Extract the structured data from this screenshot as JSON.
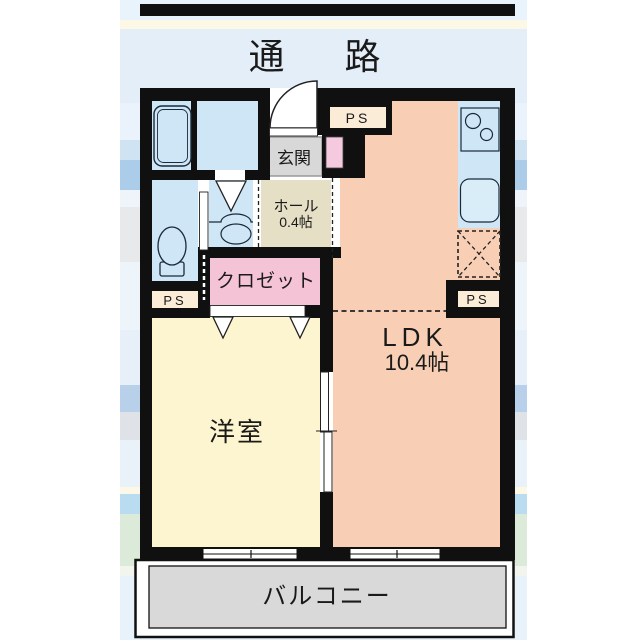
{
  "corridor": {
    "label": "通 路"
  },
  "plan": {
    "entrance": {
      "label": "玄関"
    },
    "hall": {
      "label": "ホール",
      "size": "0.4帖"
    },
    "closet": {
      "label": "クロゼット"
    },
    "western_room": {
      "label": "洋室"
    },
    "ldk": {
      "label": "LDK",
      "size": "10.4帖"
    },
    "balcony": {
      "label": "バルコニー"
    },
    "pipe_space_top": {
      "label": "PS"
    },
    "pipe_space_left": {
      "label": "PS"
    },
    "pipe_space_right": {
      "label": "PS"
    }
  },
  "colors": {
    "wall": "#101010",
    "wet_room": "#cfe6f6",
    "sink_fill": "#d9edf9",
    "ldk": "#f8cfb5",
    "western_room": "#fcf5cf",
    "closet": "#f5c3d6",
    "shoe_cabinet": "#f6cade",
    "hall": "#e5dfc5",
    "entrance_floor": "#d8d8d8",
    "balcony": "#d9d9d9",
    "pipe_space": "#fbecd8"
  }
}
